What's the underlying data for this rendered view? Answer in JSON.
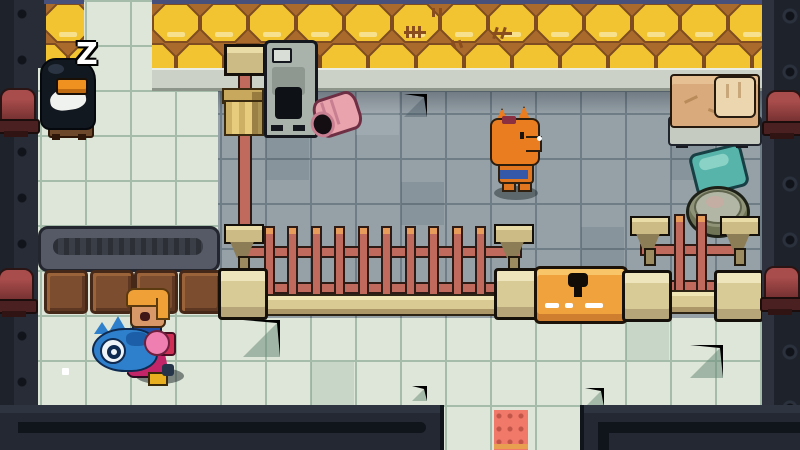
{
  "scene": {
    "description": "top-down pixel-art room with honeycomb wall, tiled floor, fences and NPCs",
    "sleep_text": "Z"
  },
  "entities": {
    "penguin": "sleeping penguin npc on stool",
    "fox": "fox npc",
    "player": "player character carrying blue fish",
    "chest": "locked orange chest",
    "bed": "bed with pillow",
    "furnace": "gray furnace machine",
    "pink_pot": "tipped pink pot",
    "gold_chair": "golden chair",
    "counter": "dark counter",
    "crates": "brown crates",
    "fence_long": "long wooden fence",
    "fence_short": "short wooden fence",
    "teal_mat": "teal mat",
    "basin": "stone basin",
    "door_mat": "red doorway mat",
    "lamps": "red wall lamps"
  },
  "palette": {
    "honeycomb": "#f2c431",
    "mortar": "#a96a2c",
    "floor_mint": "#dde6d9",
    "floor_gray": "#95a0a7",
    "wall_dark": "#1d222b",
    "lamp_red": "#9a4444",
    "fence_salmon": "#bf6a5c",
    "post_cream": "#e9dfb4",
    "chest_orange": "#f2a43c",
    "door_mat_red": "#f1796a",
    "bed_tan": "#d9ab7c",
    "teal": "#57b4ab"
  }
}
